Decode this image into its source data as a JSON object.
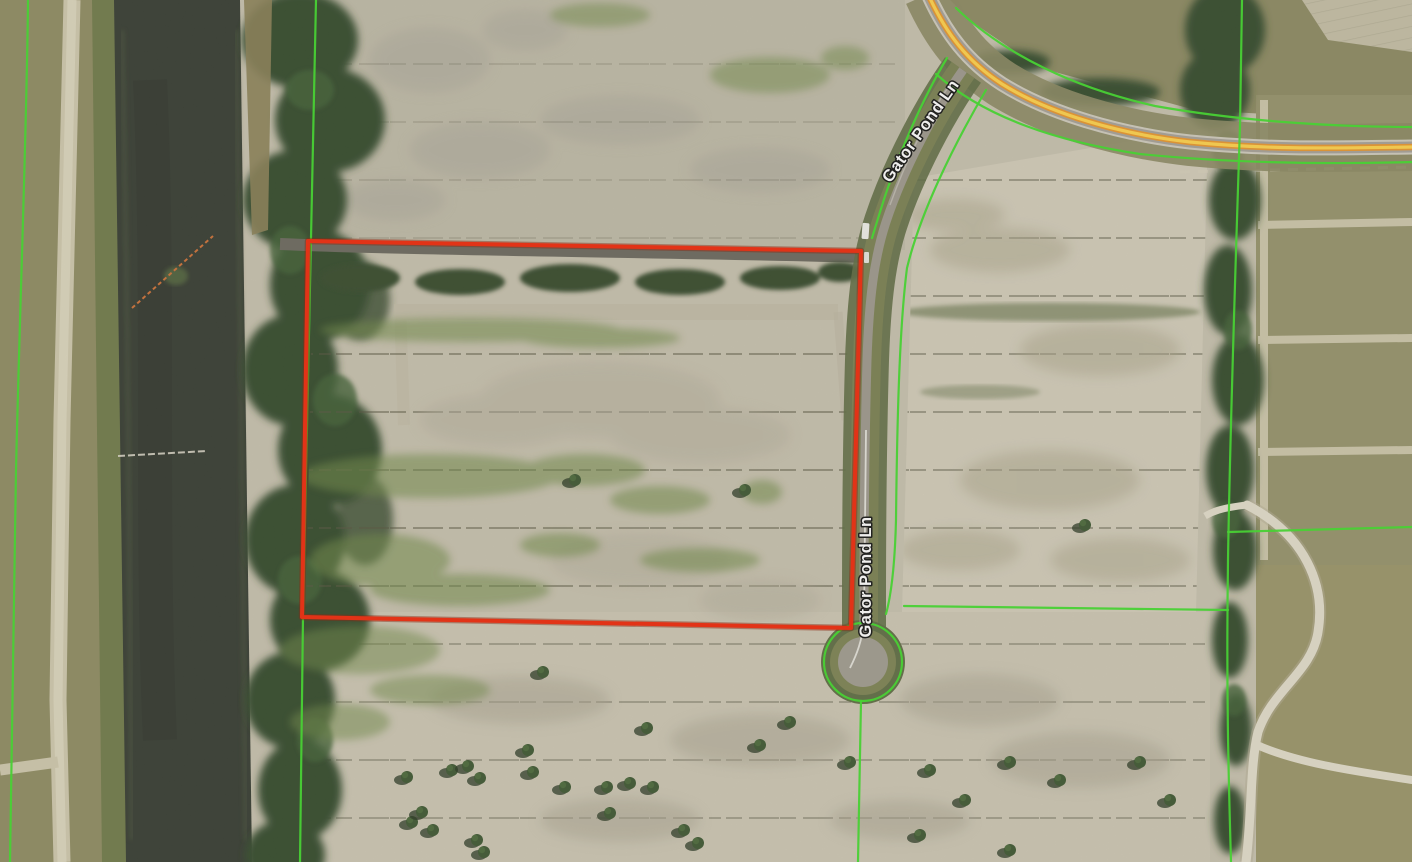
{
  "map": {
    "description": "Aerial parcel-viewer map with selected parcel outlined in red on Gator Pond Ln",
    "road_labels": [
      {
        "id": "gator-pond-ln-upper",
        "text": "Gator Pond Ln"
      },
      {
        "id": "gator-pond-ln-lower",
        "text": "Gator Pond Ln"
      }
    ],
    "selected_parcel": {
      "outline_color": "#f02708",
      "vertices_px": [
        [
          308,
          241
        ],
        [
          861,
          251
        ],
        [
          851,
          628
        ],
        [
          302,
          617
        ]
      ]
    },
    "layers": {
      "parcel_lines_color": "#3fdc2a",
      "highlighted_route": {
        "center_color": "#ffd24a",
        "casing_color": "#e8952c"
      },
      "water_color": "#343a30",
      "canal_crossing_marker_color": "#cc6f35"
    }
  },
  "colors": {
    "parcel-red": "#f02708",
    "parcel-red-dark": "#8f1a02",
    "parcel-green": "#3fdc2a",
    "route-yellow": "#ffd24a",
    "route-orange": "#e8952c",
    "water": "#343a30",
    "label-fill": "#ffffff",
    "label-halo": "#141414",
    "boom-orange": "#cc6f35"
  }
}
